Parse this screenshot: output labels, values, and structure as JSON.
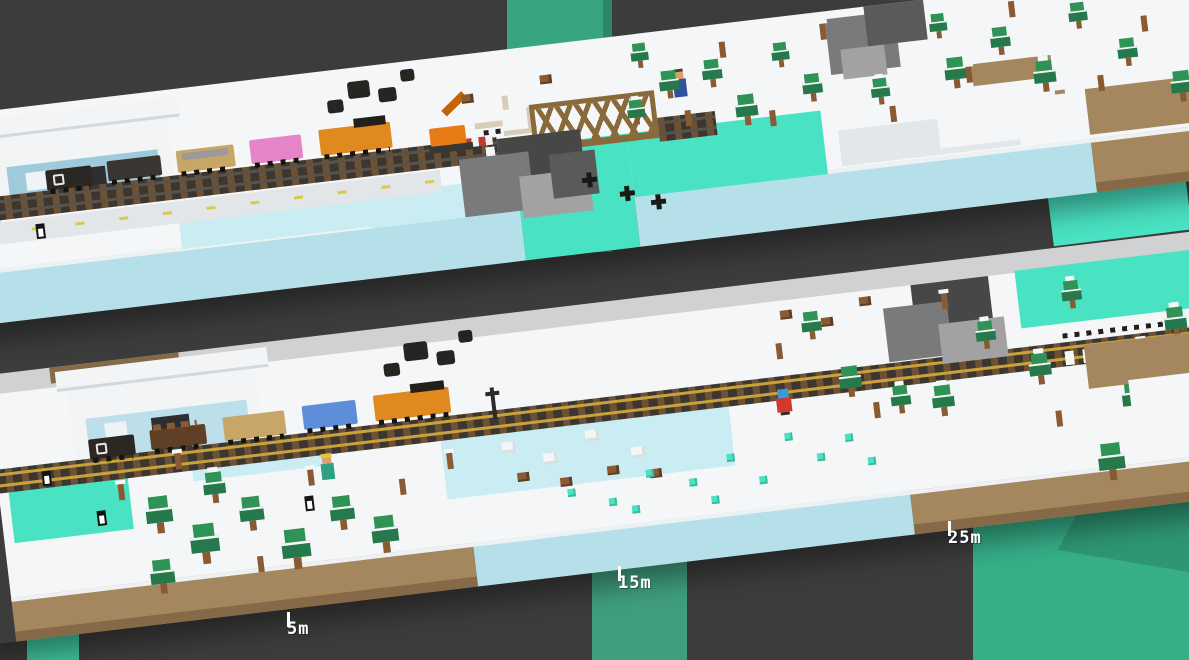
{
  "game": {
    "scene_name": "voxel-winter-train-scene",
    "markers": [
      {
        "label": "5m"
      },
      {
        "label": "15m"
      },
      {
        "label": "25m"
      }
    ],
    "colors": {
      "background": "#3c3c3c",
      "snow": "#f5f6f7",
      "snow_shade": "#e2e7ea",
      "snow_rim": "#eef1f3",
      "ice_face": "#b5dfe9",
      "dirt": "#a5875f",
      "dirt_dark": "#866a48",
      "water_bright": "#49e2c2",
      "water_pale": "#c9edf3",
      "pillar_teal": "#37a57e",
      "pillar_bright": "#3fc59c",
      "green_block": "#36ae88",
      "green_block_shade": "#2e9674",
      "tree_green": "#2f9356",
      "tree_dark": "#26794a",
      "trunk": "#8a5a33",
      "rock_light": "#a2a2a2",
      "rock_mid": "#7a7a7a",
      "rock_dark": "#5a5a5a",
      "rock_xdark": "#474747",
      "track_bed": "#3b362f",
      "tie": "#6d5134",
      "rail_gold": "#c9a23b",
      "bridge_brown": "#8a6a3a",
      "road": "#e2e6e8",
      "road_dash": "#d9ca4e",
      "red_marker": "#c23b2e",
      "loco_orange": "#e0891e",
      "crane_orange": "#e87c14",
      "car_black": "#2b2723",
      "car_gray": "#3a3530",
      "car_tan": "#c7a667",
      "car_pink": "#e584c8",
      "car_blue": "#5e8ed8",
      "car_brown": "#5f4026",
      "smoke": "#1b1916",
      "station_white": "#f3f4f5",
      "station_blue": "#9ecbdb",
      "station_blue_light": "#bcdfe9",
      "door_dark": "#2e2e2e",
      "skin": "#d9a06a",
      "miner_hair": "#e8c23f",
      "miner_shirt": "#2fa183",
      "villager_blue": "#31519e",
      "explorer_red": "#d6372b",
      "explorer_hat": "#3a9ad9",
      "penguin_black": "#141414",
      "marker_text": "#ffffff"
    }
  }
}
